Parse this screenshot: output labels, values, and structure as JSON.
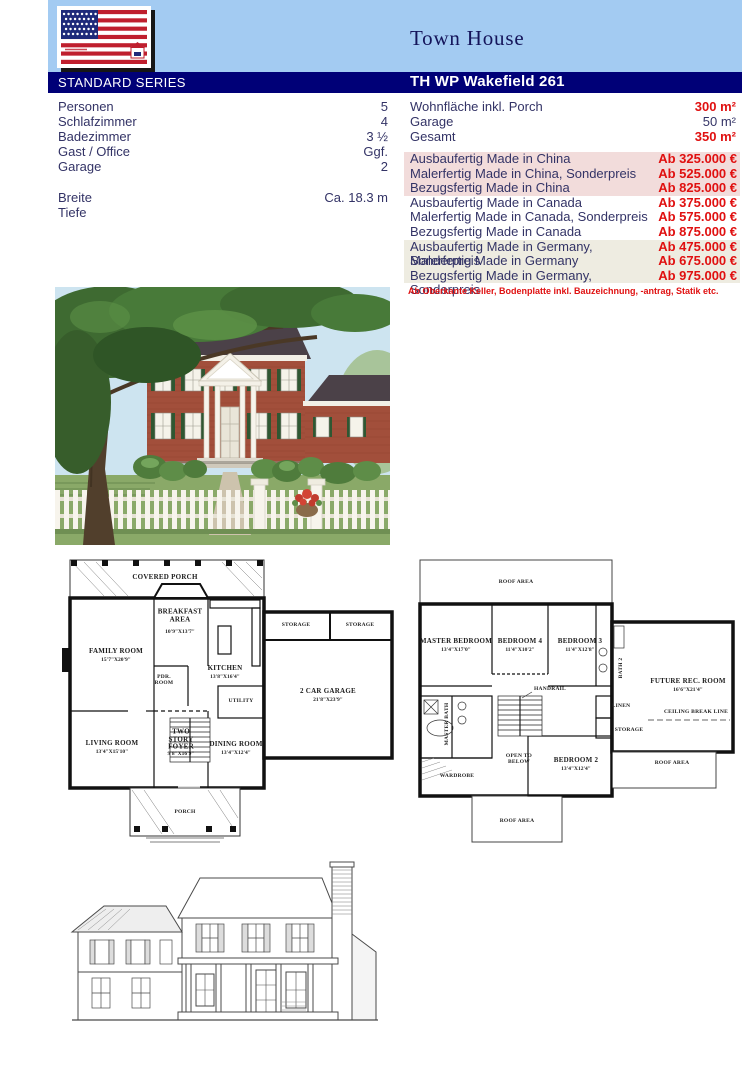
{
  "header": {
    "page_title": "Town House",
    "series_label": "STANDARD SERIES",
    "model_name": "TH WP Wakefield 261"
  },
  "icons": {
    "flag_logo": "us-flag-logo",
    "house_badge": "house-badge-icon"
  },
  "colors": {
    "band_blue": "#a3cbf2",
    "navy": "#000077",
    "text_navy": "#333366",
    "accent_red": "#e01010",
    "row_china_bg": "#f2dcdb",
    "row_canada_bg": "#ffffff",
    "row_germany_bg": "#eeece1"
  },
  "specs": {
    "rows": [
      {
        "label": "Personen",
        "value": "5"
      },
      {
        "label": "Schlafzimmer",
        "value": "4"
      },
      {
        "label": "Badezimmer",
        "value": "3 ½"
      },
      {
        "label": "Gast / Office",
        "value": "Ggf."
      },
      {
        "label": "Garage",
        "value": "2"
      }
    ],
    "rows2": [
      {
        "label": "Breite",
        "value": "Ca. 18.3 m"
      },
      {
        "label": "Tiefe",
        "value": ""
      }
    ]
  },
  "areas": {
    "rows": [
      {
        "label": "Wohnfläche inkl. Porch",
        "value": "300 m²"
      },
      {
        "label": "Garage",
        "value": "50 m²"
      },
      {
        "label": "Gesamt",
        "value": "350 m²"
      }
    ]
  },
  "prices": {
    "rows": [
      {
        "label": "Ausbaufertig Made in China",
        "price": "Ab 325.000 €",
        "group": "china"
      },
      {
        "label": "Malerfertig Made in China, Sonderpreis",
        "price": "Ab 525.000 €",
        "group": "china"
      },
      {
        "label": "Bezugsfertig Made in China",
        "price": "Ab 825.000 €",
        "group": "china"
      },
      {
        "label": "Ausbaufertig Made in Canada",
        "price": "Ab 375.000 €",
        "group": "canada"
      },
      {
        "label": "Malerfertig Made in Canada, Sonderpreis",
        "price": "Ab 575.000 €",
        "group": "canada"
      },
      {
        "label": "Bezugsfertig Made in Canada",
        "price": "Ab 875.000 €",
        "group": "canada"
      },
      {
        "label": "Ausbaufertig Made in Germany, Sonderpreis",
        "price": "Ab 475.000 €",
        "group": "germany"
      },
      {
        "label": "Malerfertig Made in Germany",
        "price": "Ab 675.000 €",
        "group": "germany"
      },
      {
        "label": "Bezugsfertig Made in Germany, Sonderpreis",
        "price": "Ab 975.000 €",
        "group": "germany"
      }
    ],
    "footnote": "Ab Oberkante Keller, Bodenplatte inkl. Bauzeichnung, -antrag, Statik etc."
  },
  "plan1": {
    "covered_porch": {
      "name": "COVERED PORCH"
    },
    "breakfast": {
      "name": "BREAKFAST AREA",
      "dim": "10'9\"X13'7\""
    },
    "family": {
      "name": "FAMILY ROOM",
      "dim": "15'7\"X20'9\""
    },
    "kitchen": {
      "name": "KITCHEN",
      "dim": "13'8\"X16'4\""
    },
    "pdr": {
      "name": "PDR. ROOM"
    },
    "utility": {
      "name": "UTILITY"
    },
    "storage_a": {
      "name": "STORAGE"
    },
    "storage_b": {
      "name": "STORAGE"
    },
    "garage": {
      "name": "2 CAR GARAGE",
      "dim": "21'8\"X23'9\""
    },
    "living": {
      "name": "LIVING ROOM",
      "dim": "13'4\"X15'10\""
    },
    "foyer": {
      "name": "TWO STORY FOYER",
      "dim": "9'8\"X16'9\""
    },
    "dining": {
      "name": "DINING ROOM",
      "dim": "13'4\"X12'4\""
    },
    "porch": {
      "name": "PORCH"
    }
  },
  "plan2": {
    "roof_top": {
      "name": "ROOF AREA"
    },
    "master": {
      "name": "MASTER BEDROOM",
      "dim": "13'4\"X17'0\""
    },
    "bed4": {
      "name": "BEDROOM 4",
      "dim": "11'4\"X10'2\""
    },
    "bed3": {
      "name": "BEDROOM 3",
      "dim": "11'4\"X12'8\""
    },
    "bath2": {
      "name": "BATH 2"
    },
    "future_rec": {
      "name": "FUTURE REC. ROOM",
      "dim": "16'6\"X21'4\""
    },
    "master_bath": {
      "name": "MASTER BATH"
    },
    "wardrobe": {
      "name": "WARDROBE"
    },
    "open_below": {
      "name": "OPEN TO BELOW"
    },
    "bed2": {
      "name": "BEDROOM 2",
      "dim": "13'4\"X12'4\""
    },
    "linen": {
      "name": "LINEN"
    },
    "storage": {
      "name": "STORAGE"
    },
    "handrail": {
      "name": "HANDRAIL"
    },
    "ceiling_break": {
      "name": "CEILING BREAK LINE"
    },
    "roof_right": {
      "name": "ROOF AREA"
    },
    "roof_bottom": {
      "name": "ROOF AREA"
    }
  }
}
